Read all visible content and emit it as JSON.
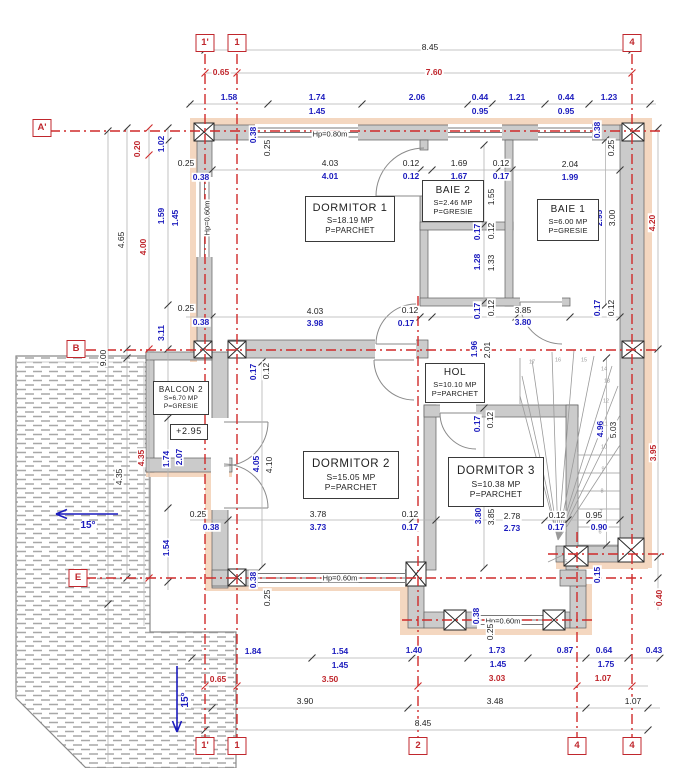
{
  "plan": {
    "colors": {
      "axis_red": "#cf2a2a",
      "dim_red": "#c0272d",
      "dim_blue": "#1c1cbe",
      "dim_black": "#1f1f1f",
      "wall_gray": "#cbcbcb",
      "insulation_pink": "#f4d7c0",
      "hatch_gray": "#a8a8a8"
    },
    "grid_bubbles": [
      {
        "t": "1'",
        "x": 205,
        "y": 43
      },
      {
        "t": "1",
        "x": 237,
        "y": 43
      },
      {
        "t": "4",
        "x": 632,
        "y": 43
      },
      {
        "t": "A'",
        "x": 42,
        "y": 128
      },
      {
        "t": "B",
        "x": 76,
        "y": 349
      },
      {
        "t": "E",
        "x": 78,
        "y": 578
      },
      {
        "t": "1'",
        "x": 205,
        "y": 746
      },
      {
        "t": "1",
        "x": 237,
        "y": 746
      },
      {
        "t": "2",
        "x": 418,
        "y": 746
      },
      {
        "t": "4",
        "x": 577,
        "y": 746
      },
      {
        "t": "4",
        "x": 632,
        "y": 746
      }
    ],
    "rooms": [
      {
        "name": "DORMITOR 1",
        "l2": "S=18.19 MP",
        "l3": "P=PARCHET",
        "x": 349,
        "y": 218,
        "w": 88,
        "h": 44,
        "fs": 11,
        "fs2": 8
      },
      {
        "name": "BAIE 2",
        "l2": "S=2.46 MP",
        "l3": "P=GRESIE",
        "x": 452,
        "y": 200,
        "w": 60,
        "h": 40,
        "fs": 10,
        "fs2": 7.5
      },
      {
        "name": "BAIE 1",
        "l2": "S=6.00 MP",
        "l3": "P=GRESIE",
        "x": 567,
        "y": 219,
        "w": 60,
        "h": 40,
        "fs": 10,
        "fs2": 7.5
      },
      {
        "name": "HOL",
        "l2": "S=10.10 MP",
        "l3": "P=PARCHET",
        "x": 454,
        "y": 382,
        "w": 58,
        "h": 38,
        "fs": 10,
        "fs2": 7.5
      },
      {
        "name": "DORMITOR 2",
        "l2": "S=15.05 MP",
        "l3": "P=PARCHET",
        "x": 350,
        "y": 474,
        "w": 94,
        "h": 46,
        "fs": 11.5,
        "fs2": 8.5
      },
      {
        "name": "DORMITOR 3",
        "l2": "S=10.38 MP",
        "l3": "P=PARCHET",
        "x": 495,
        "y": 481,
        "w": 94,
        "h": 48,
        "fs": 11.5,
        "fs2": 8.5
      },
      {
        "name": "BALCON 2",
        "l2": "S=6.70 MP",
        "l3": "P=GRESIE",
        "x": 180,
        "y": 397,
        "w": 54,
        "h": 32,
        "fs": 8,
        "fs2": 6.5
      },
      {
        "name": "+2.95",
        "x": 188,
        "y": 431,
        "w": 36,
        "h": 14,
        "fs": 9
      }
    ],
    "dims": [
      [
        "8.45",
        430,
        47,
        "k",
        0
      ],
      [
        "0.65",
        221,
        72,
        "r",
        0
      ],
      [
        "7.60",
        434,
        72,
        "r",
        0
      ],
      [
        "1.58",
        229,
        97,
        "b",
        0
      ],
      [
        "1.74",
        317,
        97,
        "b",
        0
      ],
      [
        "2.06",
        417,
        97,
        "b",
        0
      ],
      [
        "0.44",
        480,
        97,
        "b",
        0
      ],
      [
        "1.21",
        517,
        97,
        "b",
        0
      ],
      [
        "0.44",
        566,
        97,
        "b",
        0
      ],
      [
        "1.23",
        609,
        97,
        "b",
        0
      ],
      [
        "1.45",
        317,
        111,
        "b",
        0
      ],
      [
        "0.95",
        480,
        111,
        "b",
        0
      ],
      [
        "0.95",
        566,
        111,
        "b",
        0
      ],
      [
        "4.65",
        121,
        240,
        "k",
        -90
      ],
      [
        "9.00",
        103,
        358,
        "k",
        -90
      ],
      [
        "0.20",
        137,
        149,
        "r",
        -90
      ],
      [
        "4.00",
        143,
        247,
        "r",
        -90
      ],
      [
        "1.02",
        161,
        144,
        "b",
        -90
      ],
      [
        "1.59",
        161,
        216,
        "b",
        -90
      ],
      [
        "1.45",
        175,
        218,
        "b",
        -90
      ],
      [
        "3.11",
        161,
        333,
        "b",
        -90
      ],
      [
        "4.35",
        119,
        477,
        "k",
        -90
      ],
      [
        "4.35",
        141,
        458,
        "r",
        -90
      ],
      [
        "1.74",
        166,
        459,
        "b",
        -90
      ],
      [
        "2.07",
        179,
        457,
        "b",
        -90
      ],
      [
        "1.54",
        166,
        548,
        "b",
        -90
      ],
      [
        "4.20",
        652,
        223,
        "r",
        -90
      ],
      [
        "3.95",
        653,
        453,
        "r",
        -90
      ],
      [
        "0.40",
        659,
        598,
        "r",
        -90
      ],
      [
        "2.95",
        599,
        218,
        "b",
        -90
      ],
      [
        "3.00",
        612,
        218,
        "k",
        -90
      ],
      [
        "0.38",
        597,
        130,
        "b",
        -90
      ],
      [
        "0.25",
        611,
        148,
        "k",
        -90
      ],
      [
        "0.17",
        597,
        308,
        "b",
        -90
      ],
      [
        "0.12",
        611,
        308,
        "k",
        -90
      ],
      [
        "0.15",
        597,
        575,
        "b",
        -90
      ],
      [
        "0.38",
        253,
        135,
        "b",
        -90
      ],
      [
        "0.25",
        267,
        148,
        "k",
        -90
      ],
      [
        "0.25",
        186,
        163,
        "k",
        0
      ],
      [
        "0.38",
        201,
        177,
        "b",
        0
      ],
      [
        "Hp=0.60m",
        207,
        218,
        "k",
        -90,
        7.5
      ],
      [
        "0.25",
        186,
        308,
        "k",
        0
      ],
      [
        "0.38",
        201,
        322,
        "b",
        0
      ],
      [
        "Hp=0.80m",
        330,
        134,
        "k",
        0,
        7.5
      ],
      [
        "4.03",
        330,
        163,
        "k",
        0
      ],
      [
        "4.01",
        330,
        176,
        "b",
        0
      ],
      [
        "0.12",
        411,
        163,
        "k",
        0
      ],
      [
        "0.12",
        411,
        176,
        "b",
        0
      ],
      [
        "1.69",
        459,
        163,
        "k",
        0
      ],
      [
        "1.67",
        459,
        176,
        "b",
        0
      ],
      [
        "0.12",
        501,
        163,
        "k",
        0
      ],
      [
        "0.17",
        501,
        176,
        "b",
        0
      ],
      [
        "2.04",
        570,
        164,
        "k",
        0
      ],
      [
        "1.99",
        570,
        177,
        "b",
        0
      ],
      [
        "1.50",
        477,
        196,
        "b",
        -90
      ],
      [
        "1.55",
        491,
        197,
        "k",
        -90
      ],
      [
        "0.17",
        477,
        232,
        "b",
        -90
      ],
      [
        "0.12",
        491,
        231,
        "k",
        -90
      ],
      [
        "1.28",
        477,
        262,
        "b",
        -90
      ],
      [
        "1.33",
        491,
        263,
        "k",
        -90
      ],
      [
        "0.17",
        477,
        311,
        "b",
        -90
      ],
      [
        "0.12",
        491,
        308,
        "k",
        -90
      ],
      [
        "4.03",
        315,
        311,
        "k",
        0
      ],
      [
        "3.98",
        315,
        323,
        "b",
        0
      ],
      [
        "0.12",
        410,
        310,
        "k",
        0
      ],
      [
        "0.17",
        406,
        323,
        "b",
        0
      ],
      [
        "3.85",
        523,
        310,
        "k",
        0
      ],
      [
        "3.80",
        523,
        322,
        "b",
        0
      ],
      [
        "0.17",
        253,
        372,
        "b",
        -90
      ],
      [
        "0.12",
        266,
        371,
        "k",
        -90
      ],
      [
        "1.96",
        474,
        349,
        "b",
        -90
      ],
      [
        "2.01",
        487,
        350,
        "k",
        -90
      ],
      [
        "0.17",
        477,
        424,
        "b",
        -90
      ],
      [
        "0.12",
        490,
        420,
        "k",
        -90
      ],
      [
        "4.96",
        600,
        429,
        "b",
        -90
      ],
      [
        "5.03",
        613,
        430,
        "k",
        -90
      ],
      [
        "3.80",
        478,
        516,
        "b",
        -90
      ],
      [
        "3.85",
        491,
        517,
        "k",
        -90
      ],
      [
        "2.78",
        512,
        516,
        "k",
        0
      ],
      [
        "2.73",
        512,
        528,
        "b",
        0
      ],
      [
        "0.12",
        557,
        515,
        "k",
        0
      ],
      [
        "0.17",
        556,
        527,
        "b",
        0
      ],
      [
        "0.95",
        594,
        515,
        "k",
        0
      ],
      [
        "0.90",
        599,
        527,
        "b",
        0
      ],
      [
        "4.05",
        256,
        464,
        "b",
        -90
      ],
      [
        "4.10",
        269,
        465,
        "k",
        -90
      ],
      [
        "0.25",
        198,
        514,
        "k",
        0
      ],
      [
        "0.38",
        211,
        527,
        "b",
        0
      ],
      [
        "3.78",
        318,
        514,
        "k",
        0
      ],
      [
        "3.73",
        318,
        527,
        "b",
        0
      ],
      [
        "0.12",
        410,
        514,
        "k",
        0
      ],
      [
        "0.17",
        410,
        527,
        "b",
        0
      ],
      [
        "0.38",
        253,
        580,
        "b",
        -90
      ],
      [
        "0.25",
        267,
        598,
        "k",
        -90
      ],
      [
        "Hp=0.60m",
        340,
        578,
        "k",
        0,
        7.5
      ],
      [
        "Hp=0.60m",
        503,
        621,
        "k",
        0,
        7.5
      ],
      [
        "0.38",
        476,
        616,
        "b",
        -90
      ],
      [
        "0.25",
        490,
        632,
        "k",
        -90
      ],
      [
        "1.84",
        253,
        651,
        "b",
        0
      ],
      [
        "1.54",
        340,
        651,
        "b",
        0
      ],
      [
        "1.40",
        414,
        650,
        "b",
        0
      ],
      [
        "1.73",
        497,
        650,
        "b",
        0
      ],
      [
        "0.87",
        565,
        650,
        "b",
        0
      ],
      [
        "0.64",
        604,
        650,
        "b",
        0
      ],
      [
        "0.43",
        654,
        650,
        "b",
        0
      ],
      [
        "1.45",
        340,
        665,
        "b",
        0
      ],
      [
        "1.45",
        498,
        664,
        "b",
        0
      ],
      [
        "1.75",
        606,
        664,
        "b",
        0
      ],
      [
        "0.65",
        218,
        679,
        "r",
        0
      ],
      [
        "3.50",
        330,
        679,
        "r",
        0
      ],
      [
        "3.03",
        497,
        678,
        "r",
        0
      ],
      [
        "1.07",
        603,
        678,
        "r",
        0
      ],
      [
        "3.90",
        305,
        701,
        "k",
        0
      ],
      [
        "3.48",
        495,
        701,
        "k",
        0
      ],
      [
        "1.07",
        633,
        701,
        "k",
        0
      ],
      [
        "8.45",
        423,
        723,
        "k",
        0
      ],
      [
        "15°",
        88,
        526,
        "b",
        0,
        10
      ],
      [
        "15°",
        186,
        700,
        "b",
        -90,
        10
      ]
    ],
    "stair_numbers": [
      [
        "17",
        532,
        363
      ],
      [
        "16",
        558,
        361
      ],
      [
        "15",
        584,
        361
      ],
      [
        "14",
        604,
        370
      ],
      [
        "13",
        607,
        382
      ],
      [
        "12",
        606,
        402
      ],
      [
        "11",
        605,
        425
      ],
      [
        "10",
        604,
        448
      ],
      [
        "9",
        603,
        470
      ],
      [
        "8",
        602,
        492
      ],
      [
        "7",
        601,
        513
      ],
      [
        "6",
        600,
        533
      ],
      [
        "5",
        566,
        563
      ]
    ]
  }
}
